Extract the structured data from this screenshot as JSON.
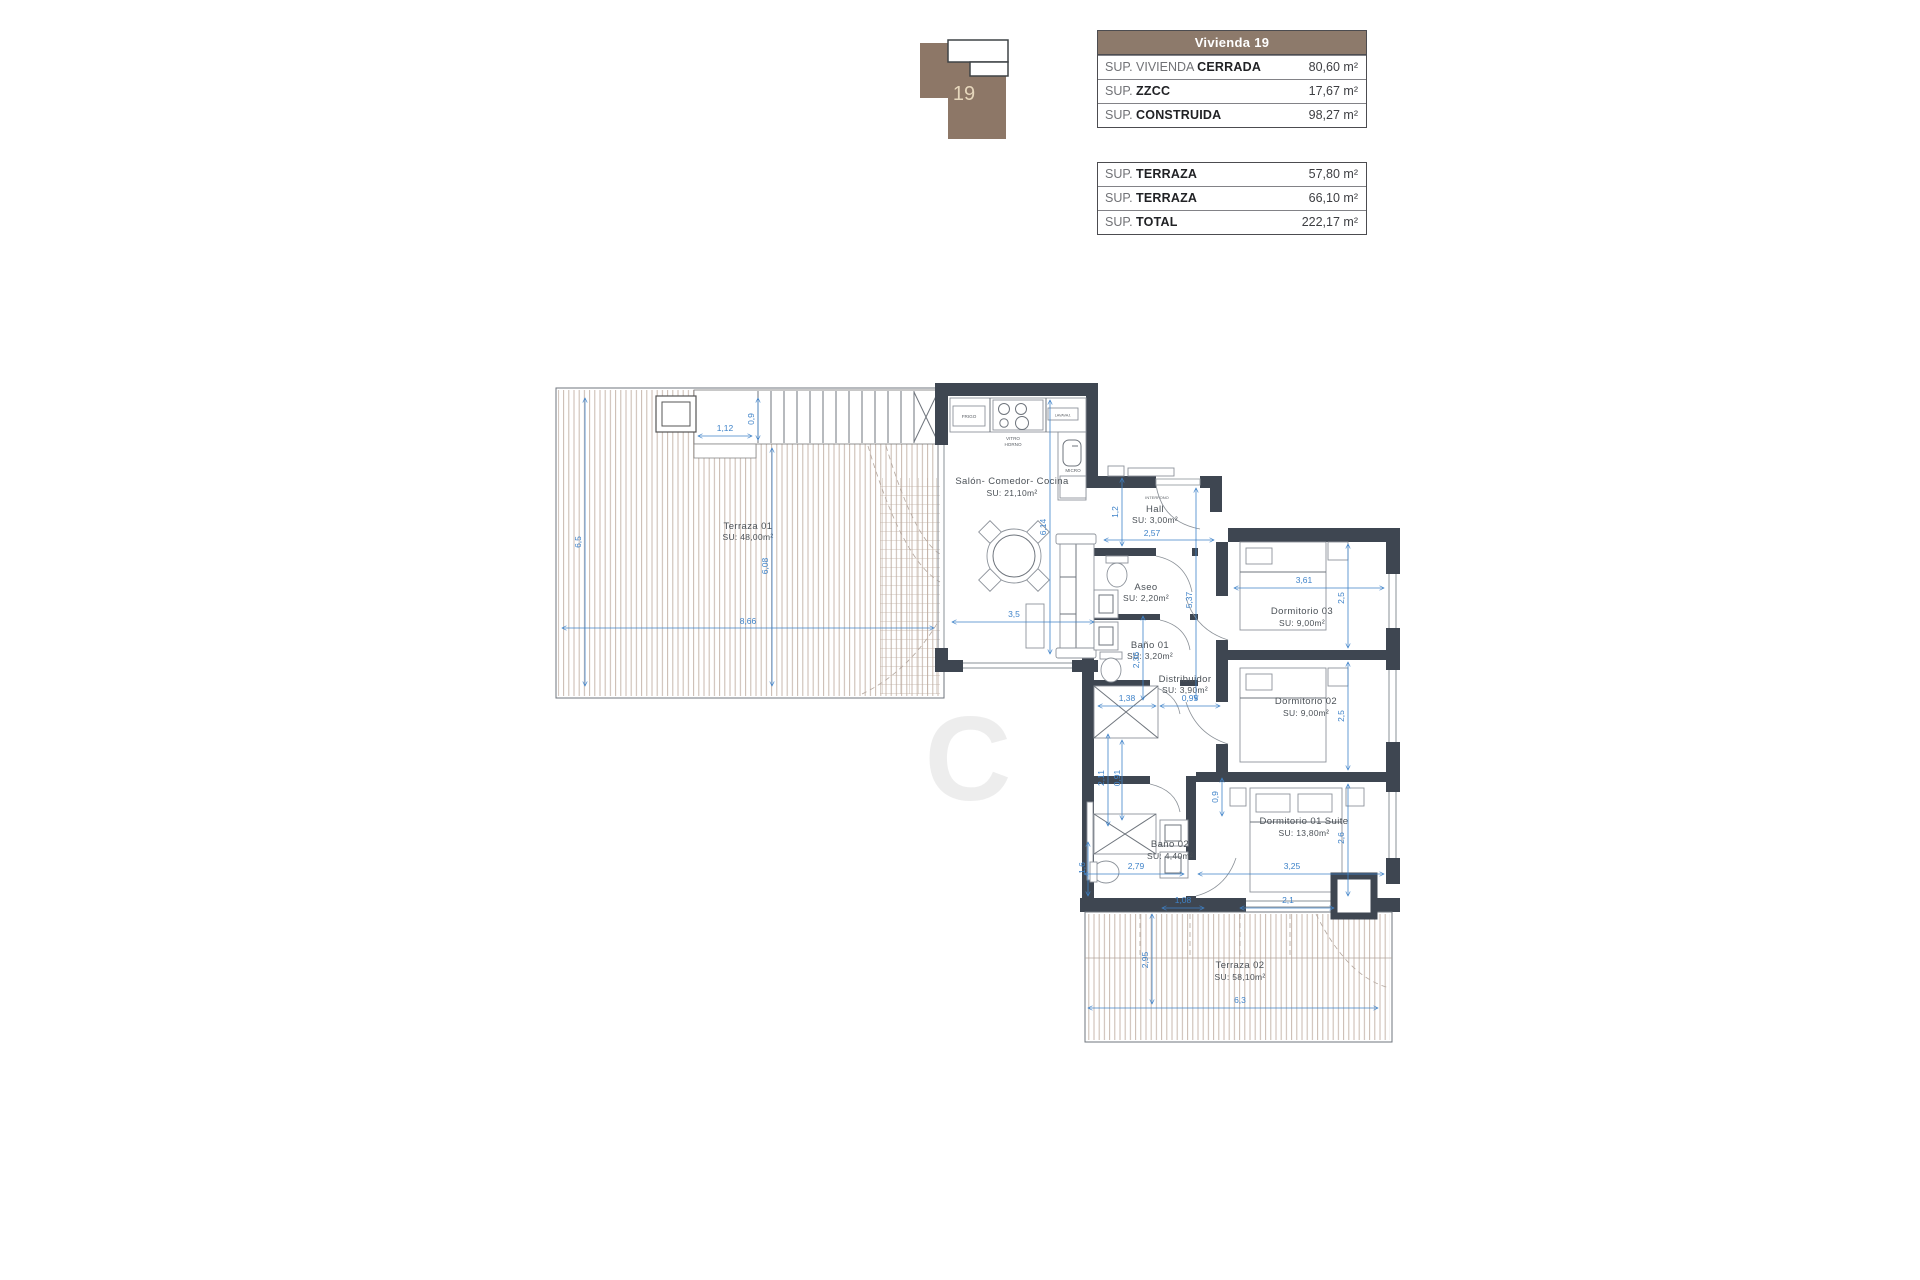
{
  "colors": {
    "accent_blue": "#3f83c9",
    "wall": "#3e4651",
    "brown": "#8d7a6b",
    "hatch": "#c9b8ae"
  },
  "key_plan": {
    "unit_label": "19"
  },
  "tables": {
    "main": {
      "header": "Vivienda 19",
      "rows": [
        {
          "prefix": "SUP. VIVIENDA ",
          "label": "CERRADA",
          "value": "80,60",
          "unit": "m²"
        },
        {
          "prefix": "SUP. ",
          "label": "ZZCC",
          "value": "17,67",
          "unit": "m²"
        },
        {
          "prefix": "SUP. ",
          "label": "CONSTRUIDA",
          "value": "98,27",
          "unit": "m²"
        }
      ]
    },
    "secondary": {
      "rows": [
        {
          "prefix": "SUP. ",
          "label": "TERRAZA",
          "value": "57,80",
          "unit": "m²"
        },
        {
          "prefix": "SUP. ",
          "label": "TERRAZA",
          "value": "66,10",
          "unit": "m²"
        },
        {
          "prefix": "SUP. ",
          "label": "TOTAL",
          "value": "222,17",
          "unit": "m²"
        }
      ]
    }
  },
  "plan": {
    "watermark": "C",
    "rooms": {
      "terraza1": {
        "name": "Terraza 01",
        "area": "SU: 48,00m²"
      },
      "salon": {
        "name": "Salón- Comedor- Cocina",
        "area": "SU: 21,10m²"
      },
      "hall": {
        "name": "Hall",
        "area": "SU: 3,00m²"
      },
      "aseo": {
        "name": "Aseo",
        "area": "SU: 2,20m²"
      },
      "bano1": {
        "name": "Baño 01",
        "area": "SU: 3,20m²"
      },
      "distribuidor": {
        "name": "Distribuidor",
        "area": "SU: 3,90m²"
      },
      "dorm3": {
        "name": "Dormitorio 03",
        "area": "SU: 9,00m²"
      },
      "dorm2": {
        "name": "Dormitorio 02",
        "area": "SU: 9,00m²"
      },
      "dorm1": {
        "name": "Dormitorio 01 Suite",
        "area": "SU: 13,80m²"
      },
      "bano2": {
        "name": "Baño 02",
        "area": "SU: 4,40m²"
      },
      "terraza2": {
        "name": "Terraza 02",
        "area": "SU: 58,10m²"
      }
    },
    "fixtures": {
      "fridge": "FRIGO",
      "hob1": "VITRO",
      "hob2": "HORNO",
      "dishwasher": "LAVAVAJ.",
      "micro": "MICRO",
      "intercom": "INTERFONO"
    },
    "dims": {
      "t1_width": "8,66",
      "t1_height": "6,5",
      "t1_inner": "6,08",
      "t1_top": "1,12",
      "t1_band": "0,9",
      "living_h": "6,14",
      "living_w": "3,5",
      "hall_v": "1,2",
      "hall_w": "2,57",
      "corridor_h": "5,37",
      "bath1_h": "2,36",
      "closet_w": "1,38",
      "dist_w": "0,95",
      "c1": "2,11",
      "c2": "0,91",
      "d1_top": "0,9",
      "d3_w": "3,61",
      "d3_h": "2,5",
      "d2_h": "2,5",
      "d1_h": "2,6",
      "d1_w": "3,25",
      "bath2_w": "2,79",
      "bath2_h": "1,6",
      "t2_h": "2,95",
      "t2_a": "1,08",
      "t2_b": "2,1",
      "t2_w": "6,3"
    }
  }
}
